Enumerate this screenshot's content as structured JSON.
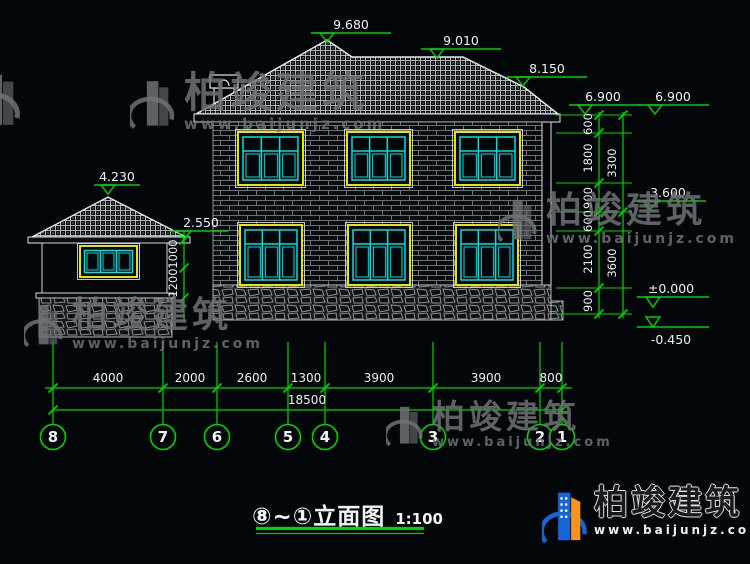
{
  "title": {
    "text": "⑧~①立面图",
    "scale": "1:100"
  },
  "watermark": {
    "brand": "柏竣建筑",
    "url": "www.baijunjz.com"
  },
  "colors": {
    "green": "#00d400",
    "yellow": "#e6e600",
    "cyan": "#00e0e0",
    "white": "#f0f2f4"
  },
  "drawing": {
    "elevation_markers": [
      {
        "label": "9.680",
        "ax": 327,
        "ay": 42,
        "ly": 33,
        "lx1": 311,
        "lx2": 391,
        "tx": 351,
        "ty": 29
      },
      {
        "label": "9.010",
        "ax": 437,
        "ay": 58,
        "ly": 49,
        "lx1": 421,
        "lx2": 501,
        "tx": 461,
        "ty": 45
      },
      {
        "label": "8.150",
        "ax": 523,
        "ay": 86,
        "ly": 77,
        "lx1": 507,
        "lx2": 587,
        "tx": 547,
        "ty": 73
      },
      {
        "label": "6.900",
        "ax": 585,
        "ay": 114,
        "ly": 105,
        "lx1": 569,
        "lx2": 641,
        "tx": 603,
        "ty": 101
      },
      {
        "label": "6.900",
        "ax": 655,
        "ay": 114,
        "ly": 105,
        "lx1": 639,
        "lx2": 709,
        "tx": 673,
        "ty": 101
      },
      {
        "label": "3.600",
        "ax": 650,
        "ay": 210,
        "ly": 201,
        "lx1": 634,
        "lx2": 706,
        "tx": 668,
        "ty": 197
      },
      {
        "label": "±0.000",
        "ax": 653,
        "ay": 307,
        "ly": 297,
        "lx1": 637,
        "lx2": 709,
        "tx": 671,
        "ty": 293
      },
      {
        "label": "-0.450",
        "ax": 653,
        "ay": 327,
        "ly": 327,
        "lx1": 637,
        "lx2": 709,
        "tx": 671,
        "ty": 344,
        "flip": true
      },
      {
        "label": "4.230",
        "ax": 108,
        "ay": 194,
        "ly": 185,
        "lx1": 94,
        "lx2": 140,
        "tx": 117,
        "ty": 181
      },
      {
        "label": "2.550",
        "ax": 184,
        "ay": 239,
        "ly": 231,
        "lx1": 170,
        "lx2": 228,
        "tx": 201,
        "ty": 227
      }
    ],
    "axis_bubbles": {
      "y": 437,
      "r": 12.5,
      "items": [
        {
          "label": "8",
          "x": 53
        },
        {
          "label": "7",
          "x": 163
        },
        {
          "label": "6",
          "x": 217
        },
        {
          "label": "5",
          "x": 288
        },
        {
          "label": "4",
          "x": 325
        },
        {
          "label": "3",
          "x": 433
        },
        {
          "label": "2",
          "x": 540
        },
        {
          "label": "1",
          "x": 562
        }
      ]
    },
    "ext_lines": {
      "y1": 342,
      "y2": 424,
      "xs": [
        53,
        163,
        217,
        288,
        325,
        433,
        540,
        562
      ]
    },
    "dim_rows": [
      {
        "y": 388,
        "x1": 45,
        "x2": 572,
        "ticks": [
          53,
          163,
          217,
          288,
          325,
          433,
          540,
          562
        ],
        "labels": [
          {
            "text": "4000",
            "x": 108
          },
          {
            "text": "2000",
            "x": 190
          },
          {
            "text": "2600",
            "x": 252
          },
          {
            "text": "1300",
            "x": 306
          },
          {
            "text": "3900",
            "x": 379
          },
          {
            "text": "3900",
            "x": 486
          },
          {
            "text": "800",
            "x": 551
          }
        ]
      },
      {
        "y": 410,
        "x1": 53,
        "x2": 562,
        "ticks": [
          53,
          562
        ],
        "labels": [
          {
            "text": "18500",
            "x": 307
          }
        ]
      }
    ],
    "left_dim": {
      "x": 184,
      "y1": 231,
      "y2": 322,
      "ticks": [
        240,
        268,
        298
      ],
      "labels": [
        {
          "text": "1000",
          "y": 254
        },
        {
          "text": "1200",
          "y": 283
        }
      ]
    },
    "right_dims": [
      {
        "x": 599,
        "y1": 112,
        "y2": 318,
        "ticks": [
          115,
          133,
          183,
          212,
          231,
          288,
          314
        ],
        "labels": [
          {
            "text": "600",
            "y": 124
          },
          {
            "text": "1800",
            "y": 158
          },
          {
            "text": "900",
            "y": 198
          },
          {
            "text": "600",
            "y": 221
          },
          {
            "text": "2100",
            "y": 259
          },
          {
            "text": "900",
            "y": 301
          }
        ]
      },
      {
        "x": 623,
        "y1": 112,
        "y2": 318,
        "ticks": [
          115,
          212,
          314
        ],
        "labels": [
          {
            "text": "3300",
            "y": 163
          },
          {
            "text": "3600",
            "y": 263
          }
        ]
      }
    ],
    "level_lines": {
      "x1": 556,
      "x2": 632,
      "ys": [
        115,
        133,
        183,
        212,
        231,
        288,
        314
      ]
    }
  }
}
